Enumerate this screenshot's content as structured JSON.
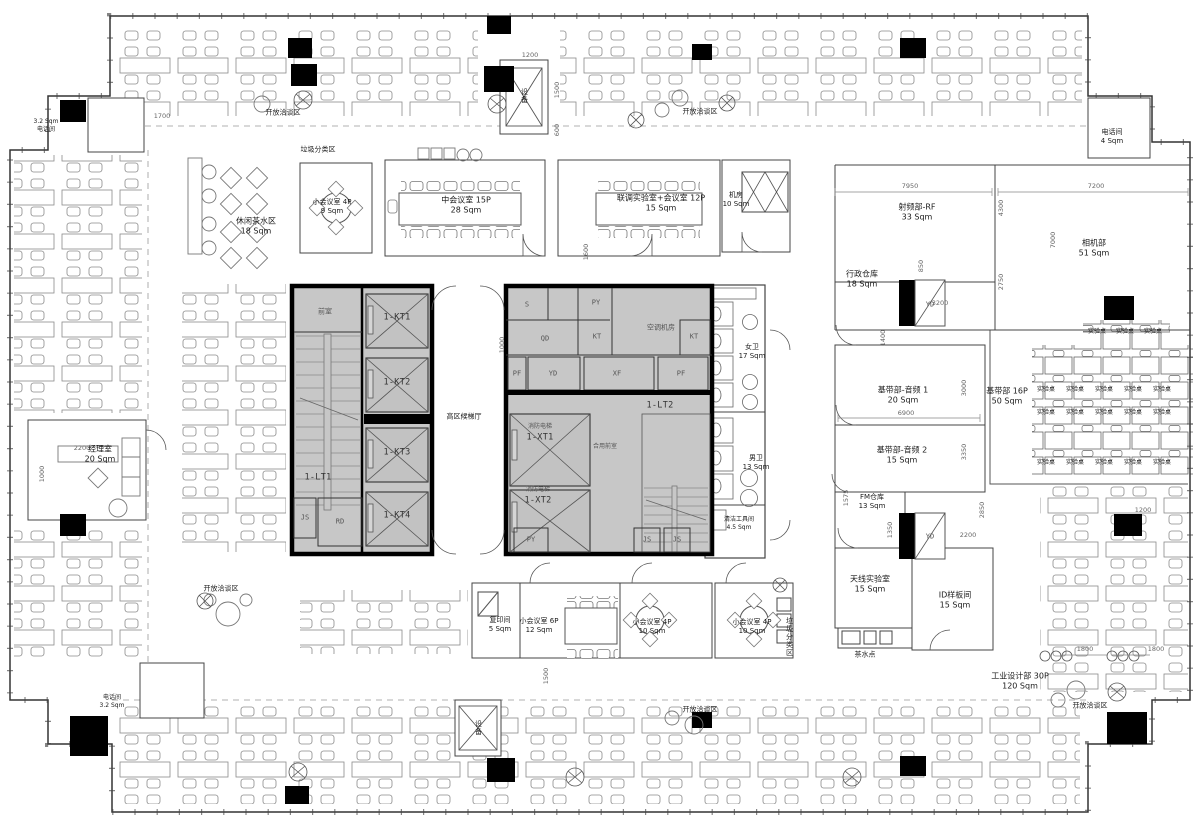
{
  "labels": {
    "open_lounge": "开放洽谈区",
    "trash_sort": "垃圾分类区",
    "tea_point": "茶水点",
    "lab_table": "实验桌",
    "equipment": "设备",
    "hvac_room": "空调机房",
    "lobby": "高区候梯厅",
    "front_room": "前室",
    "shared_front_room": "合用前室",
    "fire_elevator": "消防电梯"
  },
  "rooms": {
    "leisure_tea": {
      "name": "休闲茶水区",
      "area": "18 Sqm"
    },
    "small_meeting_4p_top": {
      "name": "小会议室 4P",
      "area": "9 Sqm"
    },
    "mid_meeting": {
      "name": "中会议室 15P",
      "area": "28 Sqm"
    },
    "joint_lab_meeting": {
      "name": "联调实验室+会议室 12P",
      "area": "15 Sqm"
    },
    "machine_room": {
      "name": "机房",
      "area": "10 Sqm"
    },
    "phone_top_right": {
      "name": "电话间",
      "area": "4 Sqm"
    },
    "rf_dept": {
      "name": "射频部-RF",
      "area": "33 Sqm"
    },
    "admin_warehouse": {
      "name": "行政仓库",
      "area": "18 Sqm"
    },
    "camera_dept": {
      "name": "相机部",
      "area": "51 Sqm"
    },
    "baseband_audio_1": {
      "name": "基带部-音频 1",
      "area": "20 Sqm"
    },
    "baseband_audio_2": {
      "name": "基带部-音频 2",
      "area": "15 Sqm"
    },
    "baseband_dept": {
      "name": "基带部 16P",
      "area": "50 Sqm"
    },
    "fm_warehouse": {
      "name": "FM仓库",
      "area": "13 Sqm"
    },
    "antenna_lab": {
      "name": "天线实验室",
      "area": "15 Sqm"
    },
    "id_sample_room": {
      "name": "ID样板间",
      "area": "15 Sqm"
    },
    "industrial_design": {
      "name": "工业设计部  30P",
      "area": "120 Sqm"
    },
    "women_wc": {
      "name": "女卫",
      "area": "17 Sqm"
    },
    "men_wc": {
      "name": "男卫",
      "area": "13 Sqm"
    },
    "cleaning_room": {
      "name": "清洁工具间",
      "area": "4.5 Sqm"
    },
    "manager_office": {
      "name": "经理室",
      "area": "20 Sqm"
    },
    "phone_top_left": {
      "name": "电话间",
      "area": "3.2 Sqm"
    },
    "phone_bottom_left": {
      "name": "电话间",
      "area": "3.2 Sqm"
    },
    "copy_room": {
      "name": "复印间",
      "area": "5 Sqm"
    },
    "small_meeting_6p": {
      "name": "小会议室 6P",
      "area": "12 Sqm"
    },
    "small_meeting_4p_mid": {
      "name": "小会议室 4P",
      "area": "10 Sqm"
    },
    "small_meeting_4p_right": {
      "name": "小会议室 4P",
      "area": "10 Sqm"
    }
  },
  "core": {
    "kt1": "1-KT1",
    "kt2": "1-KT2",
    "kt3": "1-KT3",
    "kt4": "1-KT4",
    "lt1": "1-LT1",
    "lt2": "1-LT2",
    "xt1": "1-XT1",
    "xt2": "1-XT2",
    "s": "S",
    "py": "PY",
    "qd": "QD",
    "kt": "KT",
    "yd": "YD",
    "xf": "XF",
    "pf": "PF",
    "js": "JS",
    "rd": "RD"
  },
  "dims": {
    "d1700": "1700",
    "d1200": "1200",
    "d1500": "1500",
    "d600": "600",
    "d7950": "7950",
    "d7200": "7200",
    "d4300": "4300",
    "d7000": "7000",
    "d850": "850",
    "d2750": "2750",
    "d3200": "3200",
    "d1400": "1400",
    "d3000": "3000",
    "d6900": "6900",
    "d3350": "3350",
    "d1575": "1575",
    "d1350": "1350",
    "d2850": "2850",
    "d2200": "2200",
    "d1800": "1800",
    "d1000": "1000",
    "d1600": "1600"
  },
  "colors": {
    "core_fill": "#c7c7c7",
    "wall": "#000000",
    "thin_wall": "#444444",
    "furniture": "#808080"
  }
}
